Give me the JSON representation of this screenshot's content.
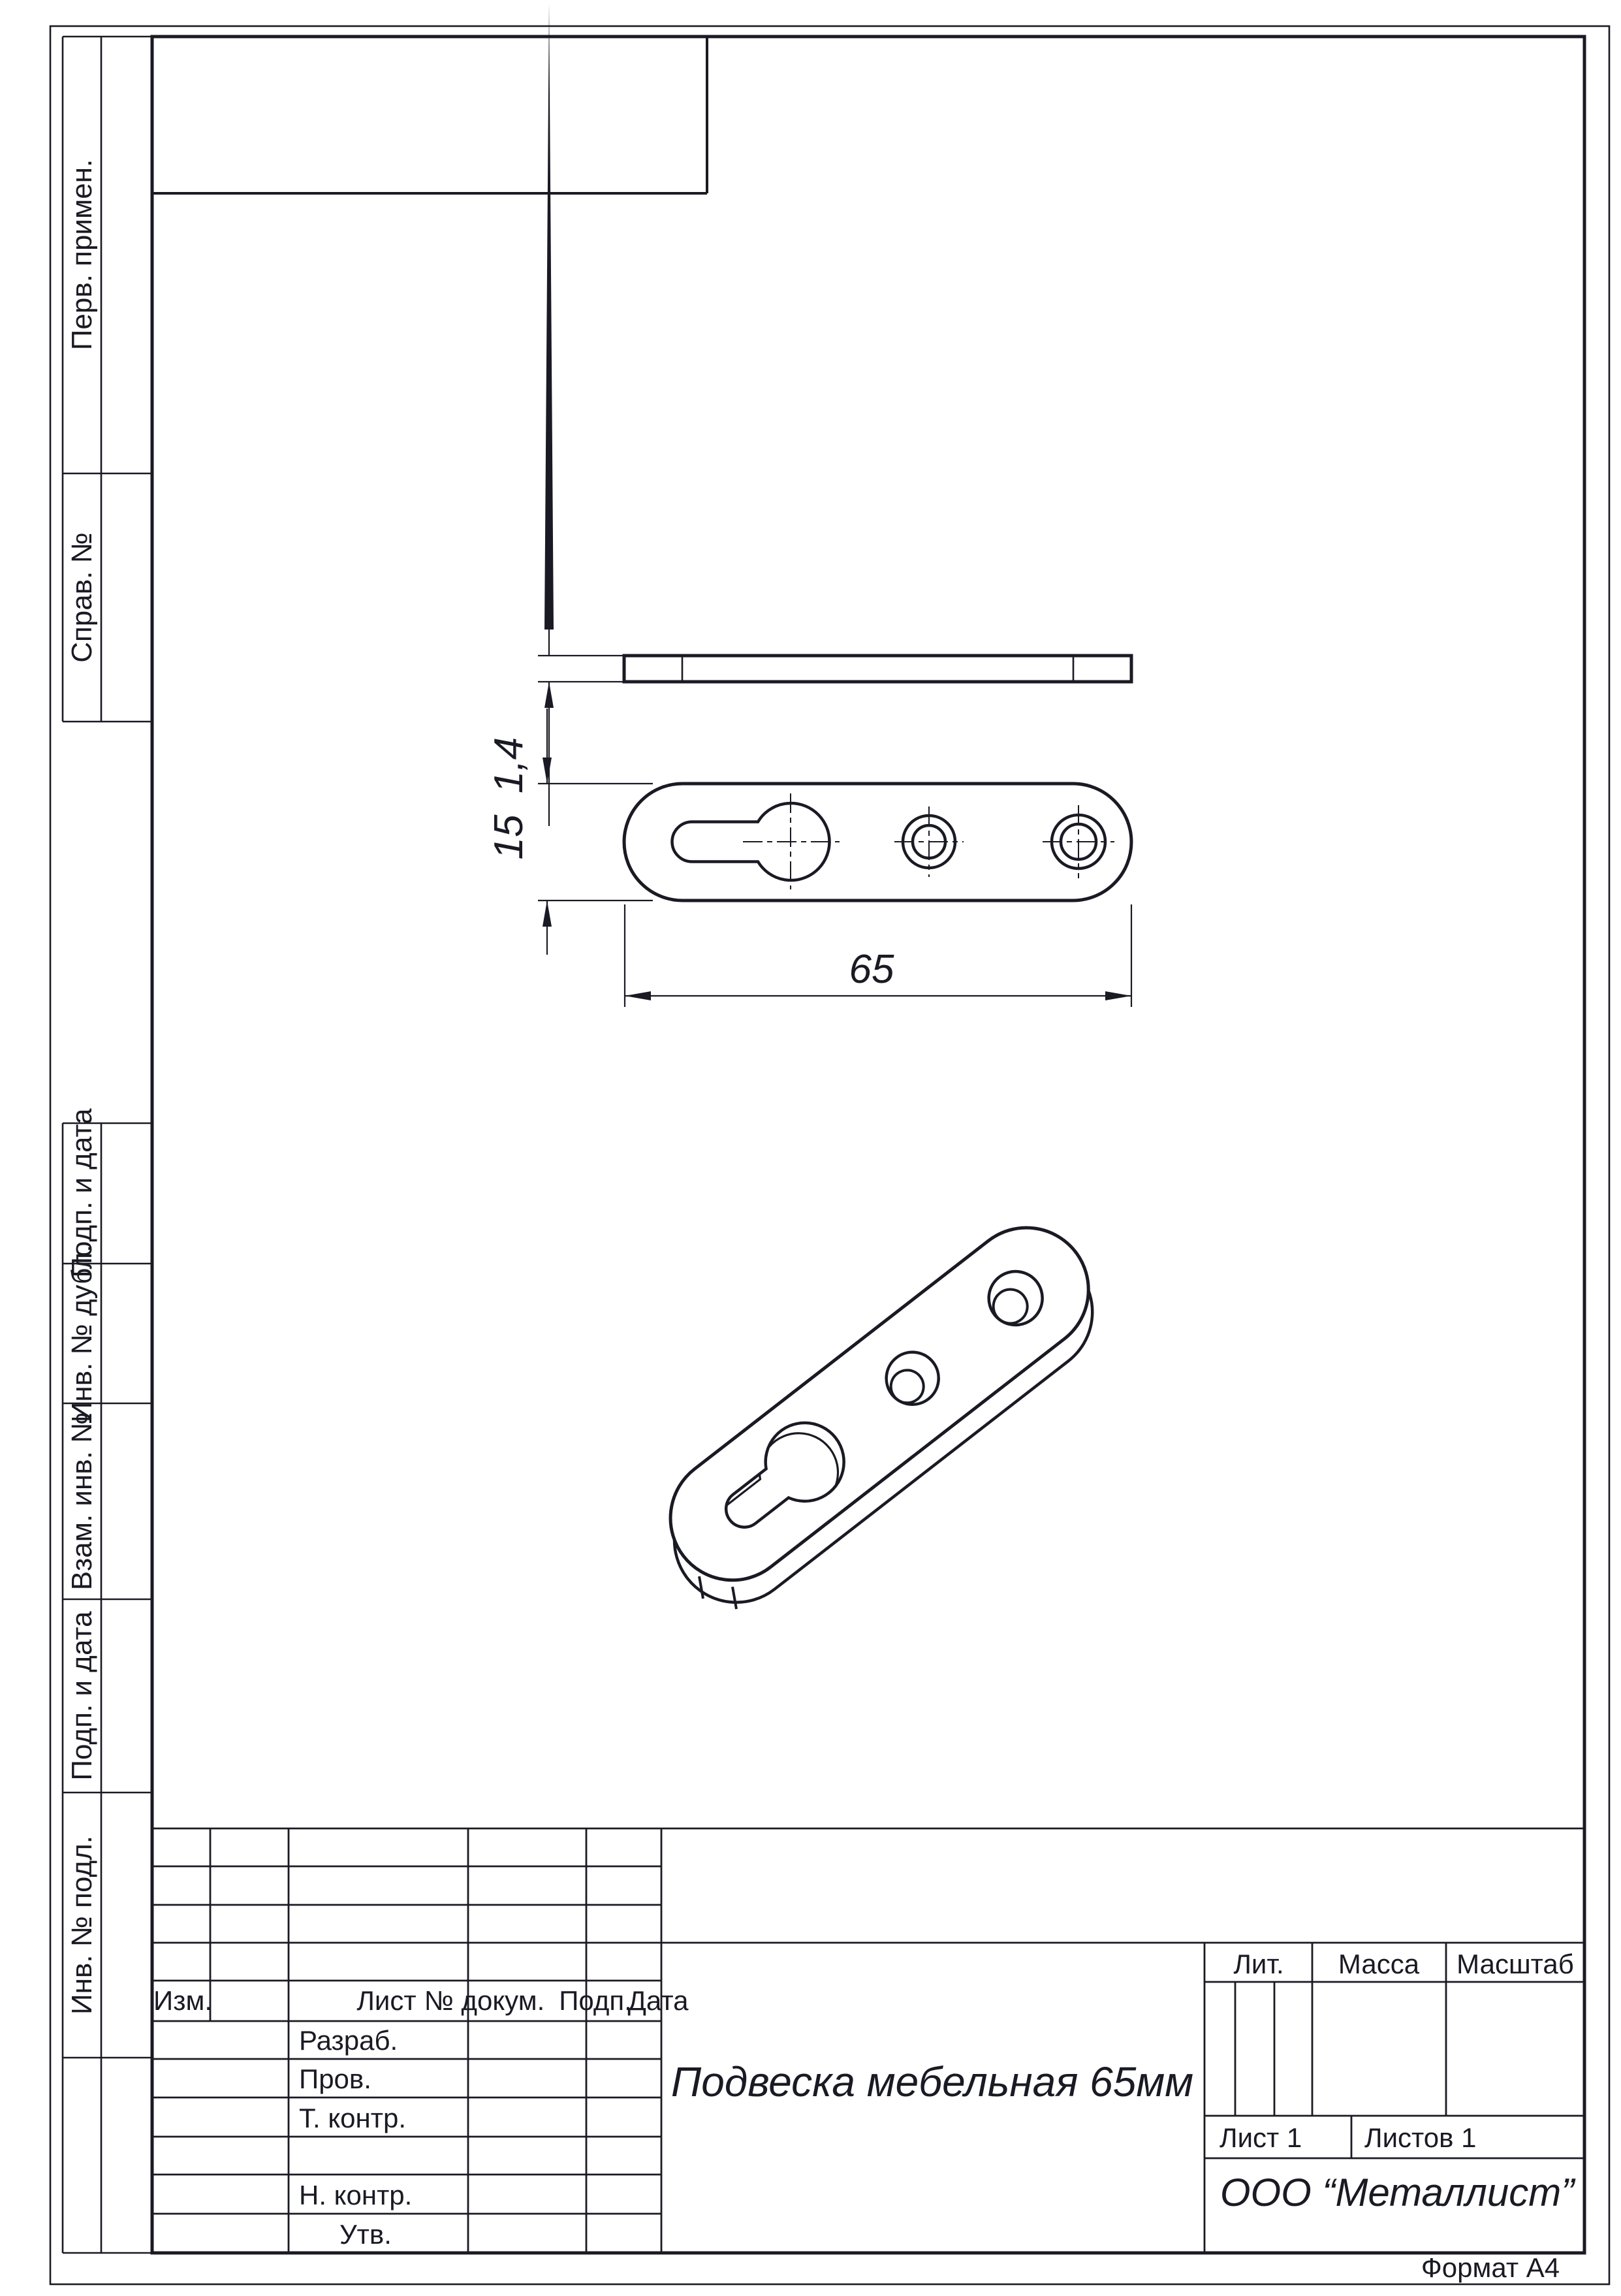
{
  "ink": "#1a1a24",
  "margin_stamps": {
    "perv_primen": "Перв. примен.",
    "sprav_no": "Справ. №",
    "podp_data_1": "Подп. и дата",
    "inv_no_dubl": "Инв. № дубл.",
    "vzam_inv_no": "Взам. инв. №",
    "podp_data_2": "Подп. и дата",
    "inv_no_podl": "Инв. № подл."
  },
  "title_block": {
    "doc_name": "Подвеска мебельная 65мм",
    "company": "ООО “Металлист”",
    "header": {
      "izm": "Изм.",
      "list": "Лист",
      "doc_no": "№ докум.",
      "podp": "Подп.",
      "data": "Дата"
    },
    "roles": {
      "razrab": "Разраб.",
      "prov": "Пров.",
      "t_kontr": "Т. контр.",
      "n_kontr": "Н. контр.",
      "utv": "Утв."
    },
    "lit_label": "Лит.",
    "massa_label": "Масса",
    "masshtab_label": "Масштаб",
    "sheet_no": "Лист 1",
    "sheets_total": "Листов 1",
    "format": "Формат А4"
  },
  "dimensions": {
    "thickness": "1,4",
    "width": "15",
    "length": "65"
  }
}
